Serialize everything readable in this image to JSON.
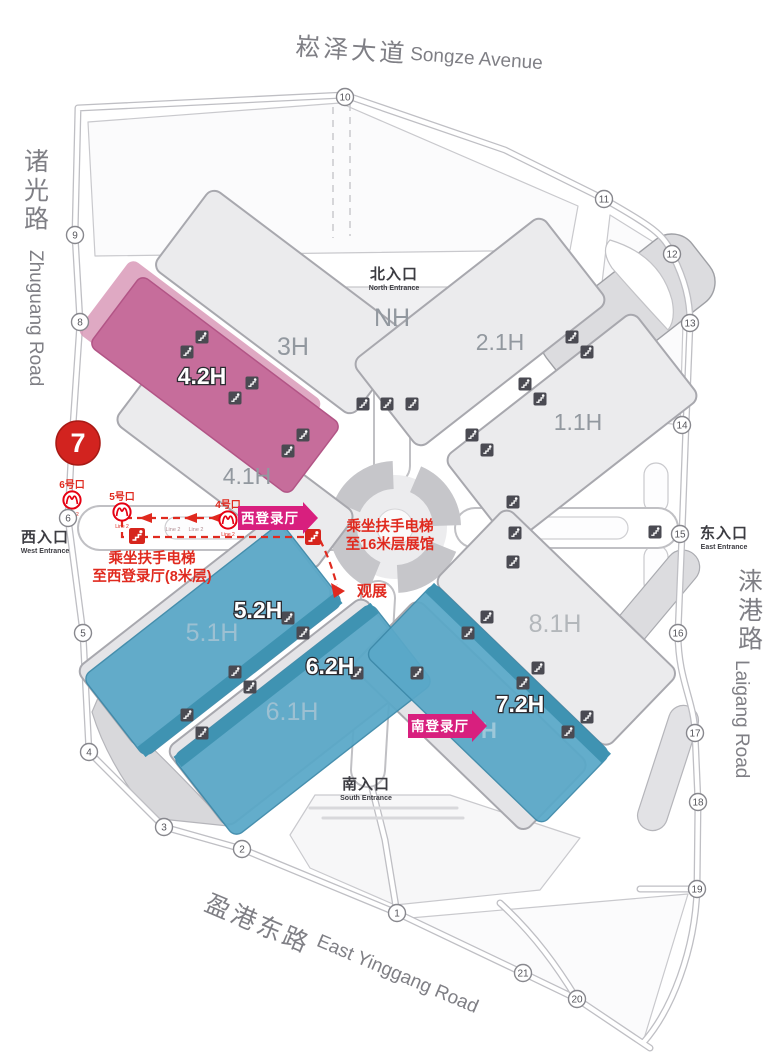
{
  "roads": {
    "top": {
      "name_zh": "崧泽大道",
      "name_en": "Songze Avenue"
    },
    "left": {
      "name_zh": "诸光路",
      "name_en": "Zhuguang Road"
    },
    "right": {
      "name_zh": "涞港路",
      "name_en": "Laigang Road"
    },
    "bottom": {
      "name_zh": "盈港东路",
      "name_en": "East Yinggang Road"
    }
  },
  "entrances": {
    "north": {
      "zh": "北入口",
      "en": "North Entrance"
    },
    "west": {
      "zh": "西入口",
      "en": "West Entrance"
    },
    "east": {
      "zh": "东入口",
      "en": "East Entrance"
    },
    "south": {
      "zh": "南入口",
      "en": "South Entrance"
    }
  },
  "halls": {
    "h3": "3H",
    "nh": "NH",
    "h21": "2.1H",
    "h11": "1.1H",
    "h42": "4.2H",
    "h41": "4.1H",
    "h52": "5.2H",
    "h51": "5.1H",
    "h62": "6.2H",
    "h61": "6.1H",
    "h72": "7.2H",
    "h71_visible": "H",
    "h81": "8.1H"
  },
  "registration_halls": {
    "west": "西登录厅",
    "south": "南登录厅"
  },
  "annotations": {
    "to_16m": {
      "line1": "乘坐扶手电梯",
      "line2": "至16米层展馆"
    },
    "to_west_hall": {
      "line1": "乘坐扶手电梯",
      "line2": "至西登录厅(8米层)"
    },
    "viewing": "观展"
  },
  "metro_exits": [
    {
      "name": "6号口",
      "line": "Line 2"
    },
    {
      "name": "5号口",
      "line": "Line 2"
    },
    {
      "name": "4号口",
      "line": "Line 2"
    }
  ],
  "corridor_line_marks": [
    "Line 2",
    "Line 2"
  ],
  "gates": {
    "numbers": [
      "1",
      "2",
      "3",
      "4",
      "5",
      "6",
      "7",
      "8",
      "9",
      "10",
      "11",
      "12",
      "13",
      "14",
      "15",
      "16",
      "17",
      "18",
      "19",
      "20",
      "21"
    ],
    "highlighted": "7"
  },
  "colors": {
    "highlight_red": "#d2231f",
    "route_red": "#e02a1f",
    "magenta_banner": "#d81f7e",
    "pink_hall": "#c66d9b",
    "blue_hall": "#5aa8c8",
    "blue_hall_dark": "#3f93b2",
    "gray_hall": "#ebebed",
    "metro_red": "#e60012"
  }
}
